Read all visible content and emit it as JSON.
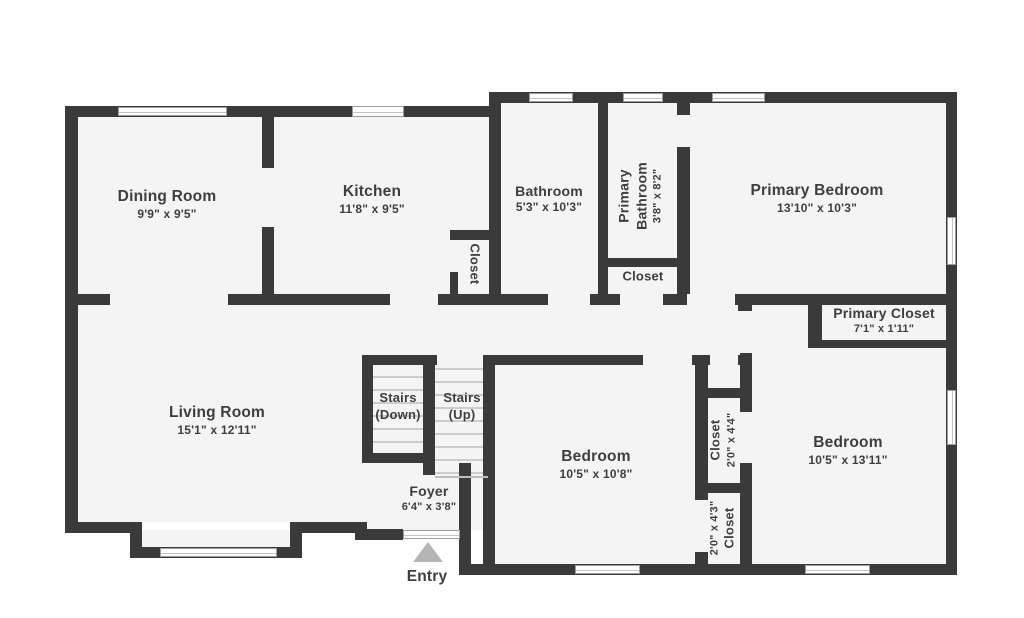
{
  "title": "Floor plan",
  "colors": {
    "wall": "#3a3a3a",
    "floor": "#f4f4f4",
    "background": "#ffffff",
    "text": "#3e3e3e",
    "entry_arrow": "#b5b5b5"
  },
  "rooms": {
    "dining": {
      "name": "Dining Room",
      "dims": "9'9\" x 9'5\""
    },
    "kitchen": {
      "name": "Kitchen",
      "dims": "11'8\" x 9'5\""
    },
    "kitchen_closet": {
      "name": "Closet"
    },
    "bathroom": {
      "name": "Bathroom",
      "dims": "5'3\" x 10'3\""
    },
    "primary_bathroom": {
      "name_line1": "Primary",
      "name_line2": "Bathroom",
      "dims": "3'8\" x 8'2\""
    },
    "primary_bathroom_closet": {
      "name": "Closet"
    },
    "primary_bedroom": {
      "name": "Primary Bedroom",
      "dims": "13'10\" x 10'3\""
    },
    "primary_closet": {
      "name": "Primary Closet",
      "dims": "7'1\" x 1'11\""
    },
    "living": {
      "name": "Living Room",
      "dims": "15'1\" x 12'11\""
    },
    "stairs_down": {
      "name_line1": "Stairs",
      "name_line2": "(Down)"
    },
    "stairs_up": {
      "name_line1": "Stairs",
      "name_line2": "(Up)"
    },
    "foyer": {
      "name": "Foyer",
      "dims": "6'4\" x 3'8\""
    },
    "bedroom_middle": {
      "name": "Bedroom",
      "dims": "10'5\" x 10'8\""
    },
    "closet_upper": {
      "name": "Closet",
      "dims": "2'0\" x 4'4\""
    },
    "closet_lower": {
      "name": "Closet",
      "dims": "2'0\" x 4'3\""
    },
    "bedroom_right": {
      "name": "Bedroom",
      "dims": "10'5\" x 13'11\""
    },
    "entry": {
      "name": "Entry"
    }
  }
}
